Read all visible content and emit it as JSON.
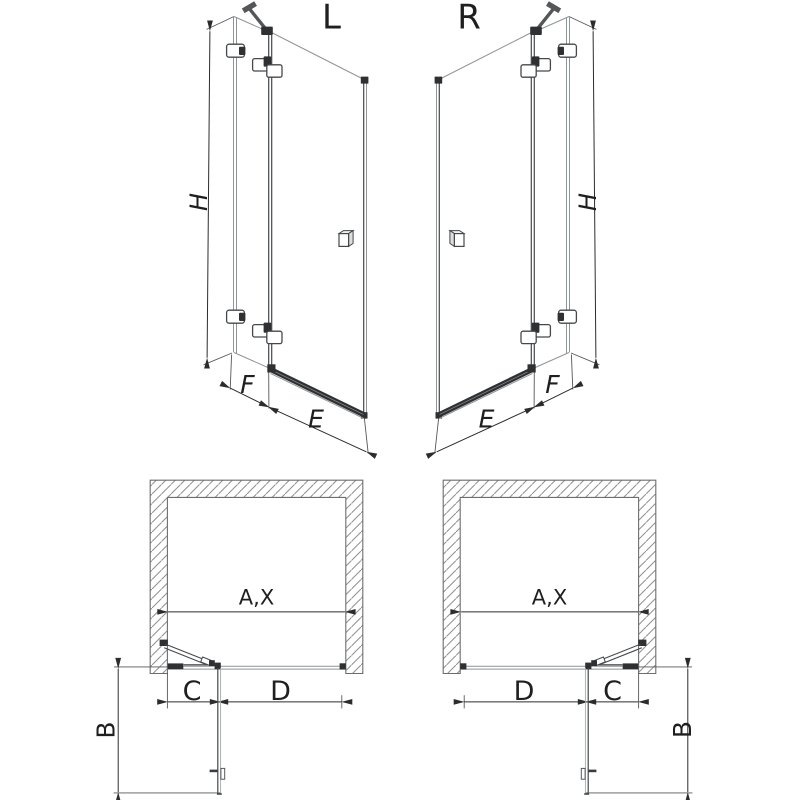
{
  "diagram": {
    "kind": "shower-door-dimension-drawing",
    "labels": {
      "variant_left": "L",
      "variant_right": "R",
      "height": "H",
      "fixed_panel_width": "F",
      "door_width": "E",
      "opening_width": "A,X",
      "door_depth": "B",
      "fixed_segment": "C",
      "door_segment": "D"
    },
    "colors": {
      "background": "#ffffff",
      "line": "#45484a",
      "line_light": "#8f9497",
      "line_dark": "#2e3032",
      "dimension": "#2c2c2c",
      "hatch": "#8f8f8f",
      "text": "#1f1f1f"
    }
  }
}
